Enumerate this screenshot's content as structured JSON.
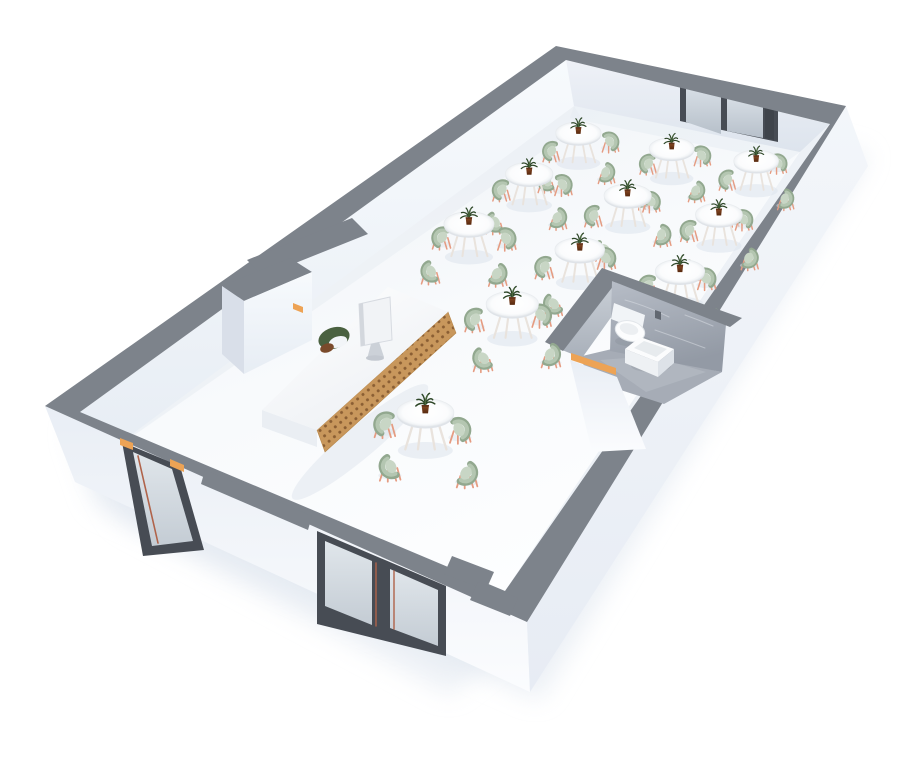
{
  "meta": {
    "kind": "3d-floorplan-render",
    "scene": "restaurant-cafe-interior",
    "view": "perspective-dollhouse-cutaway",
    "canvas": {
      "w": 900,
      "h": 764
    }
  },
  "counts": {
    "dining_tables": 11,
    "chairs_per_table": 4,
    "dining_chairs_total": 44,
    "desk_chairs": 1,
    "monitors": 1,
    "plants_on_tables": 11,
    "toilets": 1,
    "sinks": 1,
    "rear_window_panes": 2,
    "front_window_panes": 2,
    "entry_doors": 1,
    "bathroom_doors": 1
  },
  "palette": {
    "background": "#ffffff",
    "wall_top": "#7d838b",
    "wall_shade": "#d9dfe9",
    "frame_dark": "#474c54",
    "accent_orange": "#eda355",
    "trim_copper": "#b0634a",
    "wood": "#c8975c",
    "wood_dot": "#8a5e33",
    "chair_seat": "#b4c6b1",
    "chair_seat_light": "#c8d6c5",
    "chair_shade": "#92a88f",
    "chair_leg": "#e59c82",
    "table_leg": "#e9e3dd",
    "plant_green": "#2e4728",
    "plant_light": "#4a683c",
    "pot": "#7c4424",
    "bath_floor": "#a6acb6",
    "desk_chair_green": "#4a6140",
    "desk_chair_brown": "#7a4a2b",
    "shadow": "#dce3ec"
  },
  "projection": {
    "floor_quad": [
      [
        80,
        412
      ],
      [
        574,
        106
      ],
      [
        800,
        152
      ],
      [
        505,
        591
      ]
    ],
    "plan_size": [
      15,
      7.5
    ],
    "table_height_px": 34,
    "chair_radius_m": 0.95,
    "scale_near": 1.12,
    "scale_far": 0.8
  },
  "furniture": {
    "dining_tables": [
      {
        "x": 13.1,
        "y": 2.0,
        "chairs": [
          8,
          98,
          188,
          278
        ],
        "layer": "far"
      },
      {
        "x": 13.35,
        "y": 4.6,
        "chairs": [
          15,
          105,
          195,
          285
        ],
        "layer": "far"
      },
      {
        "x": 13.6,
        "y": 7.0,
        "chairs": [
          5,
          95,
          185,
          275
        ],
        "layer": "far"
      },
      {
        "x": 11.3,
        "y": 2.1,
        "chairs": [
          12,
          102,
          192,
          282
        ],
        "layer": "far"
      },
      {
        "x": 11.5,
        "y": 4.65,
        "chairs": [
          0,
          90,
          180,
          270
        ],
        "layer": "far"
      },
      {
        "x": 11.7,
        "y": 7.05,
        "chairs": [
          10,
          100,
          190,
          280
        ],
        "layer": "far"
      },
      {
        "x": 9.1,
        "y": 2.2,
        "chairs": [
          18,
          108,
          198,
          288
        ],
        "layer": "far"
      },
      {
        "x": 9.4,
        "y": 4.75,
        "chairs": [
          5,
          95,
          185,
          275
        ],
        "layer": "far"
      },
      {
        "x": 9.7,
        "y": 7.1,
        "chairs": [
          12,
          102,
          192,
          282
        ],
        "layer": "far"
      },
      {
        "x": 7.1,
        "y": 4.5,
        "chairs": [
          8,
          98,
          188,
          278
        ],
        "layer": "mid"
      },
      {
        "x": 3.0,
        "y": 4.8,
        "chairs": [
          15,
          105,
          195,
          285
        ],
        "layer": "near"
      }
    ]
  },
  "architecture": {
    "base": [
      {
        "name": "ground-shadow",
        "kind": "poly",
        "pts": "70,430 560,75 870,155 540,700 95,505",
        "fill": "#dfe6ef",
        "op": 0.6,
        "blur": true
      },
      {
        "name": "ground-shadow-near",
        "kind": "poly",
        "pts": "90,460 520,640 450,695 120,520",
        "fill": "#dde4ee",
        "op": 0.5,
        "blur": true
      },
      {
        "name": "floor",
        "kind": "poly",
        "pts": "80,412 574,106 800,152 505,591",
        "fill": "url:floorGrad"
      },
      {
        "name": "floor-ao-nw",
        "kind": "poly",
        "pts": "94,430 574,106 584,122 110,452",
        "fill": "#e8edf3",
        "op": 0.55
      },
      {
        "name": "floor-ao-ne",
        "kind": "poly",
        "pts": "574,106 800,152 786,162 570,118",
        "fill": "#e5eaf1",
        "op": 0.45
      },
      {
        "name": "nw-wall-face",
        "kind": "poly",
        "pts": "80,412 566,60 574,106 100,458",
        "fill": "url:wallLitGrad"
      },
      {
        "name": "ne-wall-face",
        "kind": "poly",
        "pts": "566,60 830,124 800,152 574,106",
        "fill": "url:wallMidGrad"
      },
      {
        "name": "se-inner-ledge",
        "kind": "poly",
        "pts": "830,124 800,152 505,591",
        "fill": "#edf1f6"
      },
      {
        "name": "rear-window-frame",
        "kind": "poly",
        "pts": "680,80 778,102 778,142 680,121",
        "fill": "frame_dark"
      },
      {
        "name": "rear-window-glass-1",
        "kind": "poly",
        "pts": "686,87 721,95 721,134 686,122",
        "fill": "url:glassGrad"
      },
      {
        "name": "rear-window-glass-2",
        "kind": "poly",
        "pts": "727,96 763,104 763,138 727,131",
        "fill": "url:glassGrad"
      },
      {
        "name": "rear-window-post",
        "kind": "poly",
        "pts": "765,102 774,104 774,140 765,138",
        "fill": "#3f444b"
      },
      {
        "name": "sw-exterior-wall",
        "kind": "poly",
        "pts": "45,406 527,622 530,692 75,482",
        "fill": "url:extSWGrad"
      },
      {
        "name": "se-exterior-wall",
        "kind": "poly",
        "pts": "846,106 868,166 530,692 527,622",
        "fill": "url:extSEGrad"
      },
      {
        "name": "wall-top-band",
        "kind": "path",
        "d": "M45,406 L556,46 L846,106 L527,622 Z M80,412 L566,60 L830,124 L505,591 Z",
        "fill": "wall_top",
        "fr": "evenodd"
      },
      {
        "name": "nw-band-notch",
        "kind": "poly",
        "pts": "247,260 352,218 368,234 263,276",
        "fill": "wall_top"
      },
      {
        "name": "sw-band-bay",
        "kind": "poly",
        "pts": "205,470 312,516 308,530 201,484",
        "fill": "wall_top"
      },
      {
        "name": "corner-step-1",
        "kind": "poly",
        "pts": "452,556 494,572 486,590 444,574",
        "fill": "wall_top"
      },
      {
        "name": "corner-step-2",
        "kind": "poly",
        "pts": "478,582 518,598 510,616 470,600",
        "fill": "wall_top"
      },
      {
        "name": "entry-door-frame",
        "kind": "poly",
        "pts": "122,442 180,466 204,550 143,556",
        "fill": "frame_dark"
      },
      {
        "name": "entry-door-glass",
        "kind": "poly",
        "pts": "133,452 172,469 193,541 152,546",
        "fill": "url:glassGrad2"
      },
      {
        "name": "entry-door-trim",
        "kind": "path",
        "d": "M138,456 L158,543",
        "stroke": "trim_copper",
        "sw": 1.6
      },
      {
        "name": "entry-door-accent-left",
        "kind": "poly",
        "pts": "120,438 133,443 133,450 120,445",
        "fill": "accent_orange"
      },
      {
        "name": "entry-door-accent-right",
        "kind": "poly",
        "pts": "170,459 184,465 184,472 170,466",
        "fill": "accent_orange"
      },
      {
        "name": "front-window-frame",
        "kind": "poly",
        "pts": "317,531 446,586 446,656 317,624",
        "fill": "frame_dark"
      },
      {
        "name": "front-window-glass-1",
        "kind": "poly",
        "pts": "325,541 372,561 372,625 325,606",
        "fill": "url:glassGrad2"
      },
      {
        "name": "front-window-glass-2",
        "kind": "poly",
        "pts": "390,569 438,590 438,646 390,628",
        "fill": "url:glassGrad2"
      },
      {
        "name": "front-window-trim",
        "kind": "path",
        "d": "M376,563 L376,626 M394,571 L394,629",
        "stroke": "trim_copper",
        "sw": 1.4
      }
    ],
    "bathroom": [
      {
        "name": "bathroom-floor",
        "kind": "poly",
        "pts": "578,357 612,349 722,372 664,404 596,382",
        "fill": "bath_floor"
      },
      {
        "name": "bathroom-floor-sheen",
        "kind": "poly",
        "pts": "600,360 652,356 706,372 646,392",
        "fill": "#c3c8d0",
        "op": 0.35
      },
      {
        "name": "bathroom-wall-nw-marble",
        "kind": "poly",
        "pts": "562,350 618,278 622,302 582,358",
        "fill": "url:marbleGrad"
      },
      {
        "name": "bathroom-vein-1",
        "kind": "path",
        "d": "M572,336 Q586,314 598,302",
        "stroke": "#e8ebef",
        "sw": 1,
        "op": 0.55
      },
      {
        "name": "bathroom-wall-nw-band",
        "kind": "poly",
        "pts": "545,342 602,268 621,276 563,351",
        "fill": "wall_top"
      },
      {
        "name": "bathroom-wall-ne-marble",
        "kind": "poly",
        "pts": "612,281 726,324 722,372 610,351",
        "fill": "url:marbleGrad2"
      },
      {
        "name": "bathroom-vein-2",
        "kind": "path",
        "d": "M625,300 q22,6 44,17 M655,330 q26,9 50,18 M640,315 q-8,14 -12,26 M685,315 q14,5 28,11",
        "stroke": "#dde1e7",
        "sw": 1,
        "op": 0.5
      },
      {
        "name": "bathroom-wall-ne-band",
        "kind": "poly",
        "pts": "602,268 742,318 730,327 612,281",
        "fill": "wall_top"
      },
      {
        "name": "toilet-shadow",
        "kind": "ellipse",
        "cx": 633,
        "cy": 341,
        "rx": 18,
        "ry": 5.5,
        "fill": "#878e98",
        "op": 0.35
      },
      {
        "name": "toilet-cistern",
        "kind": "poly",
        "pts": "614,303 645,315 642,331 611,319",
        "fill": "#f1f4f7"
      },
      {
        "name": "toilet-bowl",
        "kind": "ellipse",
        "cx": 630,
        "cy": 331,
        "rx": 15,
        "ry": 10,
        "rot": 16,
        "fill": "#fcfdfe",
        "stroke": "#e2e6ea",
        "sw": 1
      },
      {
        "name": "toilet-seat",
        "kind": "ellipse",
        "cx": 629,
        "cy": 329,
        "rx": 9.5,
        "ry": 5.5,
        "rot": 16,
        "fill": "#eceff2"
      },
      {
        "name": "bathroom-faucet",
        "kind": "poly",
        "pts": "655,310 661,312 661,320 655,318",
        "fill": "#626871"
      },
      {
        "name": "sink-shadow",
        "kind": "ellipse",
        "cx": 651,
        "cy": 366,
        "rx": 20,
        "ry": 6,
        "fill": "#878e98",
        "op": 0.3
      },
      {
        "name": "sink-top",
        "kind": "poly",
        "pts": "640,337 674,349 658,362 625,349",
        "fill": "#fbfcfd"
      },
      {
        "name": "sink-basin",
        "kind": "poly",
        "pts": "644,341 667,349 656,357 634,348",
        "fill": "#e7ebee"
      },
      {
        "name": "sink-front-left",
        "kind": "poly",
        "pts": "625,349 658,362 658,377 625,363",
        "fill": "#eef1f4"
      },
      {
        "name": "sink-front-right",
        "kind": "poly",
        "pts": "658,362 674,349 674,363 658,377",
        "fill": "#dde2e8"
      },
      {
        "name": "bathroom-entry-wall",
        "kind": "poly",
        "pts": "570,360 617,377 646,449 592,452",
        "fill": "url:extSWGrad"
      },
      {
        "name": "bathroom-door-threshold",
        "kind": "poly",
        "pts": "571,353 616,368 616,375 571,360",
        "fill": "accent_orange"
      }
    ],
    "reception": [
      {
        "name": "vestibule-band",
        "kind": "poly",
        "pts": "222,286 290,258 312,272 244,301",
        "fill": "wall_top"
      },
      {
        "name": "vestibule-face-se",
        "kind": "poly",
        "pts": "244,301 312,272 312,340 244,374",
        "fill": "url:wallLitGrad"
      },
      {
        "name": "vestibule-face-sw",
        "kind": "poly",
        "pts": "222,286 244,301 244,374 222,354",
        "fill": "wall_shade"
      },
      {
        "name": "vestibule-accent",
        "kind": "poly",
        "pts": "293,303 303,307 303,313 293,309",
        "fill": "accent_orange"
      },
      {
        "name": "desk-shadow",
        "kind": "ellipse",
        "cx": 360,
        "cy": 442,
        "rx": 88,
        "ry": 16,
        "rot": -40,
        "fill": "#dce3ec",
        "op": 0.45
      },
      {
        "name": "desk-side-panel",
        "kind": "poly",
        "pts": "262,410 317,430 317,447 262,427",
        "fill": "#eaeef3"
      },
      {
        "name": "desk-wood-front",
        "kind": "poly",
        "pts": "448,312 456,333 325,452 317,430",
        "fill": "url:woodDots",
        "stroke": "#b58549",
        "sw": 0.6
      },
      {
        "name": "desk-top",
        "kind": "poly",
        "pts": "262,410 388,287 448,312 317,430",
        "fill": "url:deskTopGrad"
      },
      {
        "name": "desk-chair-back",
        "kind": "ellipse",
        "cx": 334,
        "cy": 338,
        "rx": 16,
        "ry": 10.5,
        "rot": -18,
        "fill": "desk_chair_green"
      },
      {
        "name": "desk-chair-inner",
        "kind": "ellipse",
        "cx": 338,
        "cy": 342,
        "rx": 9.5,
        "ry": 5.5,
        "rot": -18,
        "fill": "#f2f5f8"
      },
      {
        "name": "desk-chair-seat",
        "kind": "ellipse",
        "cx": 327,
        "cy": 348,
        "rx": 7,
        "ry": 4.5,
        "rot": -18,
        "fill": "desk_chair_brown"
      },
      {
        "name": "monitor-screen",
        "kind": "poly",
        "pts": "359,304 390,297 392,340 361,346",
        "fill": "#f1f3f6",
        "stroke": "#d7dbe1",
        "sw": 1
      },
      {
        "name": "monitor-edge",
        "kind": "poly",
        "pts": "359,304 363,303 365,345 361,346",
        "fill": "#d3d7dd"
      },
      {
        "name": "monitor-stand",
        "kind": "poly",
        "pts": "371,344 379,342 384,357 367,359",
        "fill": "#ccd1d8"
      },
      {
        "name": "monitor-base",
        "kind": "ellipse",
        "cx": 375,
        "cy": 358,
        "rx": 9,
        "ry": 2.8,
        "fill": "#c3c8d0"
      }
    ]
  }
}
